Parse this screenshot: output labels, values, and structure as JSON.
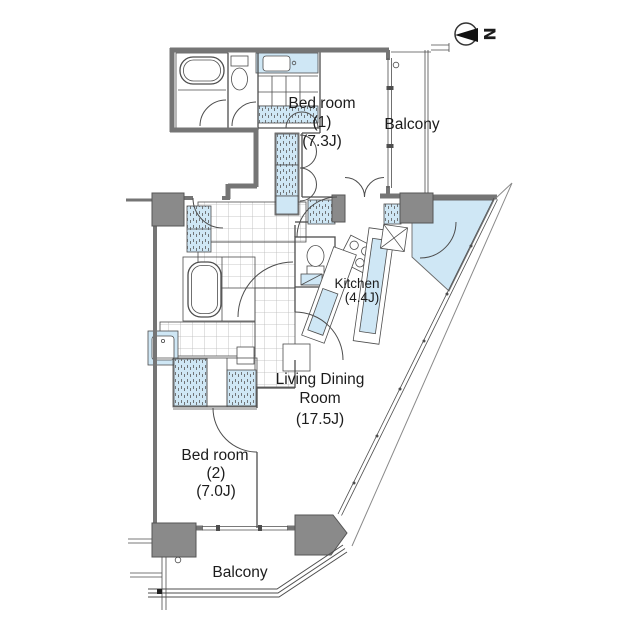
{
  "compass": {
    "letter": "N"
  },
  "rooms": {
    "bedroom1": {
      "name": "Bed room",
      "number": "(1)",
      "size": "(7.3J)"
    },
    "balcony_top": {
      "name": "Balcony"
    },
    "kitchen": {
      "name": "Kitchen",
      "size": "(4.4J)"
    },
    "living": {
      "name_line1": "Living Dining",
      "name_line2": "Room",
      "size": "(17.5J)"
    },
    "bedroom2": {
      "name": "Bed room",
      "number": "(2)",
      "size": "(7.0J)"
    },
    "balcony_bottom": {
      "name": "Balcony"
    }
  },
  "colors": {
    "wall_gray": "#757575",
    "column_gray": "#8a8a8a",
    "water_blue": "#cfe7f5",
    "line": "#4d4d4d"
  }
}
